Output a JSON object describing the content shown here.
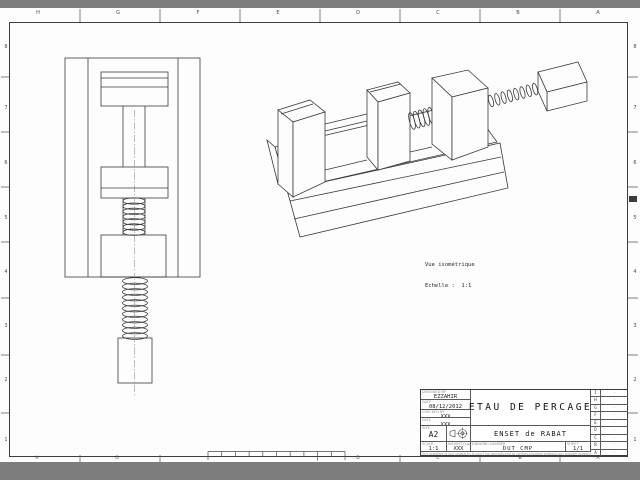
{
  "zones": {
    "top": [
      "H",
      "G",
      "F",
      "E",
      "D",
      "C",
      "B",
      "A"
    ],
    "bottom": [
      "H",
      "G",
      "D",
      "C",
      "B",
      "A"
    ],
    "left": [
      "8",
      "7",
      "6",
      "5",
      "4",
      "3",
      "2",
      "1"
    ],
    "right": [
      "8",
      "7",
      "6",
      "5",
      "4",
      "3",
      "2",
      "1"
    ]
  },
  "iso_caption": {
    "line1": "Vue isométrique",
    "line2": "Echelle :  1:1"
  },
  "title_block": {
    "designed_by_label": "DESIGNED BY",
    "designed_by": "EZZAHIR",
    "date_label": "DATE",
    "date": "08/12/2012",
    "checked_by_label": "CHECKED BY",
    "checked_by": "XXX",
    "checked_date_label": "DATE",
    "checked_date": "XXX",
    "size_label": "SIZE",
    "size": "A2",
    "title": "ETAU DE PERCAGE",
    "subtitle": "ENSET de RABAT",
    "scale_label": "SCALE",
    "scale": "1:1",
    "weight_label": "WEIGHT (kg)",
    "weight": "XXX",
    "drawing_number_label": "DRAWING NUMBER",
    "drawing_number": "DUT CMP",
    "sheet_label": "SHEET",
    "sheet": "1/1",
    "disclaimer": "This drawing is our property. It can't be reproduced or communicated without our written agreement.",
    "revisions": [
      "I",
      "H",
      "G",
      "F",
      "E",
      "D",
      "C",
      "B",
      "A"
    ],
    "revision_mark": "-"
  },
  "colors": {
    "surround": "#7d7d7d",
    "paper": "#fdfdfd",
    "line": "#3a3a3a"
  }
}
